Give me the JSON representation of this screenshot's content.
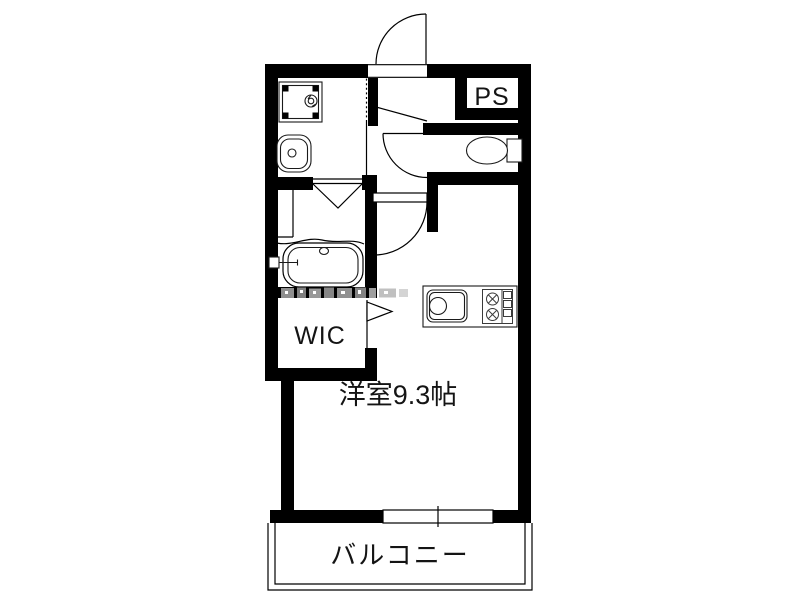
{
  "floorplan": {
    "labels": {
      "ps": "PS",
      "wic": "WIC",
      "main_room": "洋室9.3帖",
      "balcony": "バルコニー"
    },
    "colors": {
      "wall": "#000000",
      "line": "#000000",
      "text": "#141414",
      "watermark_gray": "#909090",
      "background": "#ffffff"
    }
  }
}
